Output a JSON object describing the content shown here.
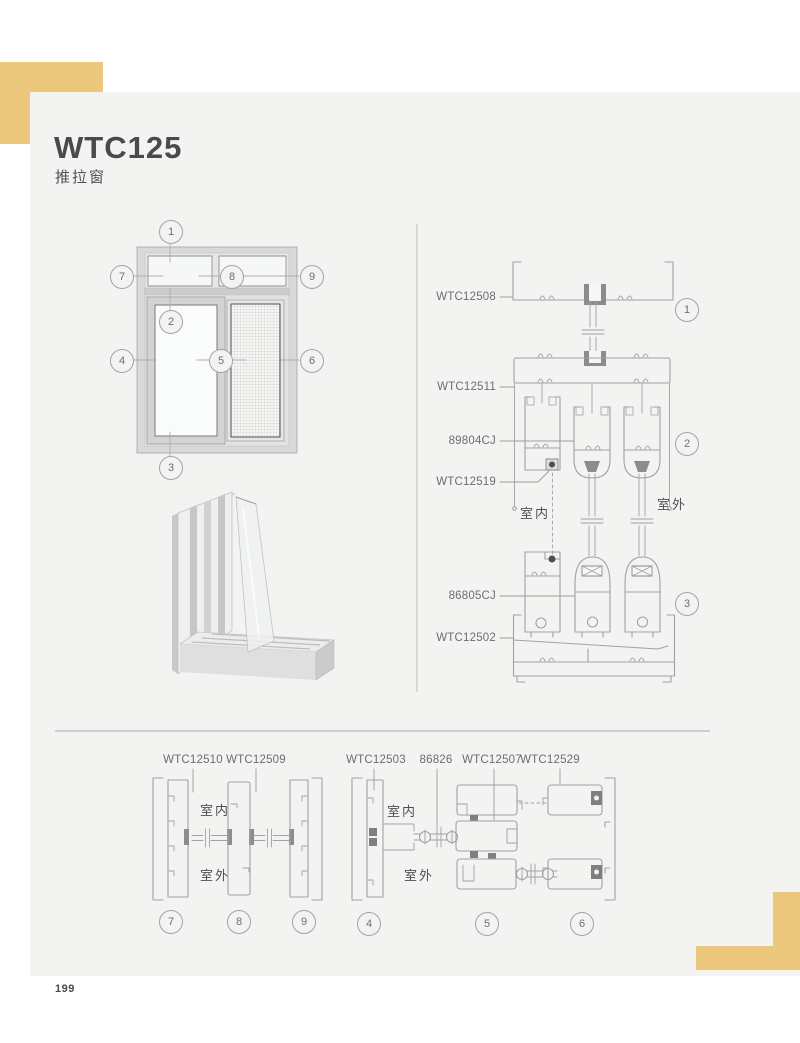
{
  "page": {
    "title": "WTC125",
    "subtitle": "推拉窗",
    "page_number": "199"
  },
  "colors": {
    "accent_yellow": "#ecc87d",
    "page_background": "#f3f3f2",
    "line_art": "#a2a2a2",
    "dark_fill": "#8c8c8c"
  },
  "elevation": {
    "callouts": [
      "1",
      "2",
      "3",
      "4",
      "5",
      "6",
      "7",
      "8",
      "9"
    ]
  },
  "vertical_section": {
    "indoor_label": "室内",
    "outdoor_label": "室外",
    "callouts": [
      "1",
      "2",
      "3"
    ],
    "part_labels": [
      "WTC12508",
      "WTC12511",
      "89804CJ",
      "WTC12519",
      "86805CJ",
      "WTC12502"
    ]
  },
  "horizontal_section_left": {
    "indoor_label": "室内",
    "outdoor_label": "室外",
    "callouts": [
      "7",
      "8",
      "9"
    ],
    "part_labels": [
      "WTC12510",
      "WTC12509"
    ]
  },
  "horizontal_section_right": {
    "indoor_label": "室内",
    "outdoor_label": "室外",
    "callouts": [
      "4",
      "5",
      "6"
    ],
    "part_labels": [
      "WTC12503",
      "86826",
      "WTC12507",
      "WTC12529"
    ]
  }
}
